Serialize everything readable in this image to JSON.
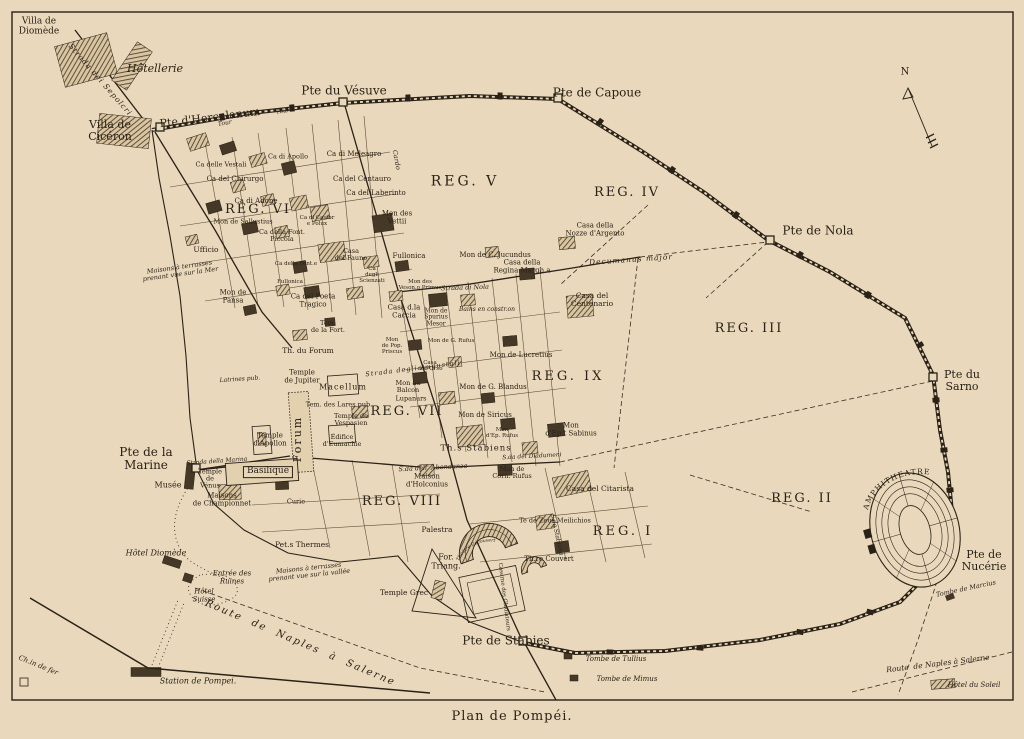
{
  "page": {
    "title": "Plan de Pompéi."
  },
  "colors": {
    "paper": "#e9d8bb",
    "ink": "#2a2217",
    "hatch": "#4a3c28"
  },
  "map": {
    "curved": {
      "amphitheatre": "AMPHITHEATRE",
      "grand_theatre": "Théâtre Découvert"
    },
    "labels": [
      {
        "n": "villa-de-diomede",
        "t": "Villa de\nDiomède",
        "x": 39,
        "y": 27,
        "s": 9
      },
      {
        "n": "hotellerie",
        "t": "Hôtellerie",
        "x": 155,
        "y": 69,
        "s": 11,
        "i": 1
      },
      {
        "n": "villa-de-ciceron",
        "t": "Villa de\nCicéron",
        "x": 110,
        "y": 131,
        "s": 11
      },
      {
        "n": "pte-herculanum",
        "t": "Pte d'Herculanum",
        "x": 210,
        "y": 118,
        "s": 11,
        "r": -7
      },
      {
        "n": "strada-dei-sepolcri",
        "t": "Strada dei Sepolcri",
        "x": 100,
        "y": 80,
        "s": 7.5,
        "i": 1,
        "r": 49,
        "l": 1
      },
      {
        "n": "tour-1",
        "t": "Tour",
        "x": 225,
        "y": 124,
        "s": 6,
        "i": 1,
        "r": -10
      },
      {
        "n": "tour-2",
        "t": "Tour",
        "x": 283,
        "y": 112,
        "s": 6,
        "i": 1,
        "r": -8
      },
      {
        "n": "pte-vesuve",
        "t": "Pte du Vésuve",
        "x": 344,
        "y": 91,
        "s": 12
      },
      {
        "n": "pte-capoue",
        "t": "Pte de Capoue",
        "x": 597,
        "y": 93,
        "s": 12
      },
      {
        "n": "pte-nola",
        "t": "Pte de Nola",
        "x": 818,
        "y": 231,
        "s": 12
      },
      {
        "n": "pte-sarno",
        "t": "Pte du\nSarno",
        "x": 962,
        "y": 381,
        "s": 11
      },
      {
        "n": "pte-nucerie",
        "t": "Pte de\nNucérie",
        "x": 984,
        "y": 561,
        "s": 11
      },
      {
        "n": "pte-stabies",
        "t": "Pte de Stabies",
        "x": 506,
        "y": 641,
        "s": 12
      },
      {
        "n": "pte-marine",
        "t": "Pte de la\nMarine",
        "x": 146,
        "y": 459,
        "s": 12
      },
      {
        "n": "compass-n",
        "t": "N",
        "x": 905,
        "y": 73,
        "s": 10
      },
      {
        "n": "reg-v",
        "t": "REG. V",
        "x": 465,
        "y": 182,
        "s": 14,
        "l": 3
      },
      {
        "n": "reg-iv",
        "t": "REG. IV",
        "x": 627,
        "y": 193,
        "s": 13,
        "l": 2
      },
      {
        "n": "reg-iii",
        "t": "REG. III",
        "x": 749,
        "y": 329,
        "s": 13,
        "l": 2
      },
      {
        "n": "reg-vi",
        "t": "REG. VI",
        "x": 258,
        "y": 210,
        "s": 13,
        "l": 2
      },
      {
        "n": "reg-ix",
        "t": "REG. IX",
        "x": 568,
        "y": 377,
        "s": 13,
        "l": 3
      },
      {
        "n": "reg-vii",
        "t": "REG. VII",
        "x": 407,
        "y": 412,
        "s": 13,
        "l": 2
      },
      {
        "n": "reg-viii",
        "t": "REG. VIII",
        "x": 402,
        "y": 502,
        "s": 13,
        "l": 2
      },
      {
        "n": "reg-ii",
        "t": "REG. II",
        "x": 802,
        "y": 499,
        "s": 13,
        "l": 2
      },
      {
        "n": "reg-i",
        "t": "REG. I",
        "x": 623,
        "y": 532,
        "s": 13,
        "l": 3
      },
      {
        "n": "ca-delle-vestali",
        "t": "Ca delle Vestali",
        "x": 221,
        "y": 165,
        "s": 6.5
      },
      {
        "n": "ca-del-chirurgo",
        "t": "Ca del Chirurgo",
        "x": 235,
        "y": 180,
        "s": 7
      },
      {
        "n": "ca-di-adone",
        "t": "Ca di Adone",
        "x": 256,
        "y": 202,
        "s": 7
      },
      {
        "n": "mon-de-sallustius",
        "t": "Mon de Sallustius",
        "x": 243,
        "y": 222,
        "s": 6.5
      },
      {
        "n": "ufficio",
        "t": "Ufficio",
        "x": 206,
        "y": 250,
        "s": 7.5
      },
      {
        "n": "ca-della-font-piccola",
        "t": "Ca della Font.\nPiccola",
        "x": 282,
        "y": 236,
        "s": 6.5
      },
      {
        "n": "ca-di-apollo",
        "t": "Ca di Apollo",
        "x": 288,
        "y": 157,
        "s": 6.5
      },
      {
        "n": "ca-di-meleagro",
        "t": "Ca di Meleagro",
        "x": 354,
        "y": 155,
        "s": 7
      },
      {
        "n": "ca-del-centauro",
        "t": "Ca del Centauro",
        "x": 362,
        "y": 180,
        "s": 7
      },
      {
        "n": "ca-del-laberinto",
        "t": "Ca del Laberinto",
        "x": 376,
        "y": 194,
        "s": 7
      },
      {
        "n": "mon-des-vettii",
        "t": "Mon des\nVettii",
        "x": 397,
        "y": 218,
        "s": 7
      },
      {
        "n": "ca-di-castor",
        "t": "Ca di Castor\ne Polux",
        "x": 317,
        "y": 222,
        "s": 5.5
      },
      {
        "n": "casa-del-fauno",
        "t": "Casa\ndel Fauno",
        "x": 351,
        "y": 255,
        "s": 6.5
      },
      {
        "n": "fullonica-1",
        "t": "Fullonica",
        "x": 409,
        "y": 257,
        "s": 7
      },
      {
        "n": "ca-degli-scienzati",
        "t": "Ca\ndegli\nScienzati",
        "x": 372,
        "y": 276,
        "s": 5.5
      },
      {
        "n": "mon-veson-primus",
        "t": "Mon des\nVeson.o Primus",
        "x": 420,
        "y": 286,
        "s": 5.5
      },
      {
        "n": "ca-del-poeta-tragico",
        "t": "Ca del Poeta\nTragico",
        "x": 313,
        "y": 301,
        "s": 7
      },
      {
        "n": "mon-de-pansa",
        "t": "Mon de\nPansa",
        "x": 233,
        "y": 297,
        "s": 7
      },
      {
        "n": "maisons-terrasses-mer",
        "t": "Maisons à terrasses\nprenant vue sur la Mer",
        "x": 180,
        "y": 271,
        "s": 6.5,
        "i": 1,
        "r": -8
      },
      {
        "n": "ca-della-fontana",
        "t": "Ca della Font.e",
        "x": 296,
        "y": 265,
        "s": 5.5
      },
      {
        "n": "fullonica-2",
        "t": "Fullonica",
        "x": 290,
        "y": 283,
        "s": 5.5
      },
      {
        "n": "tem-de-la-fortune",
        "t": "Tem.\nde la Fort.",
        "x": 328,
        "y": 327,
        "s": 6.5
      },
      {
        "n": "th-du-forum",
        "t": "Th. du Forum",
        "x": 308,
        "y": 351,
        "s": 7.5
      },
      {
        "n": "temple-de-jupiter",
        "t": "Temple\nde Jupiter",
        "x": 302,
        "y": 377,
        "s": 7
      },
      {
        "n": "macellum",
        "t": "Macellum",
        "x": 343,
        "y": 388,
        "s": 8,
        "l": 1
      },
      {
        "n": "tem-des-lares",
        "t": "Tem. des Lares pub.",
        "x": 339,
        "y": 405,
        "s": 6.5
      },
      {
        "n": "temple-vespasien",
        "t": "Temple de\nVespasien",
        "x": 351,
        "y": 420,
        "s": 6.5
      },
      {
        "n": "edifice-eumachie",
        "t": "Édifice\nd'Eumachie",
        "x": 342,
        "y": 441,
        "s": 6.5
      },
      {
        "n": "mon-au-balcon",
        "t": "Mon au\nBalcon",
        "x": 408,
        "y": 387,
        "s": 6.5
      },
      {
        "n": "lupanars",
        "t": "Lupanars",
        "x": 411,
        "y": 399,
        "s": 6.5
      },
      {
        "n": "temple-apollon",
        "t": "Temple\nd'Apollon",
        "x": 270,
        "y": 440,
        "s": 7
      },
      {
        "n": "forum",
        "t": "Forum",
        "x": 298,
        "y": 439,
        "s": 11,
        "r": -90,
        "l": 2
      },
      {
        "n": "basilique",
        "t": "Basilique",
        "x": 268,
        "y": 472,
        "s": 9,
        "b": 1
      },
      {
        "n": "latrines",
        "t": "Latrines pub.",
        "x": 240,
        "y": 380,
        "s": 6,
        "i": 1,
        "r": -4
      },
      {
        "n": "temple-de-venus",
        "t": "Temple\nde\nVénus",
        "x": 210,
        "y": 479,
        "s": 6.5
      },
      {
        "n": "musee",
        "t": "Musée",
        "x": 168,
        "y": 486,
        "s": 8
      },
      {
        "n": "maisons-championnet",
        "t": "Maisons\nde Championnet",
        "x": 222,
        "y": 500,
        "s": 7
      },
      {
        "n": "curie",
        "t": "Curie",
        "x": 296,
        "y": 502,
        "s": 6.5
      },
      {
        "n": "petits-thermes",
        "t": "Pet.s Thermes",
        "x": 302,
        "y": 545,
        "s": 7.5
      },
      {
        "n": "maison-holconius",
        "t": "Maison\nd'Holconius",
        "x": 427,
        "y": 481,
        "s": 7
      },
      {
        "n": "maisons-terrasses-vallee",
        "t": "Maisons à terrasses\nprenant vue sur la vallée",
        "x": 309,
        "y": 572,
        "s": 6.5,
        "i": 1,
        "r": -6
      },
      {
        "n": "hotel-diomede",
        "t": "Hôtel Diomède",
        "x": 156,
        "y": 554,
        "s": 8,
        "i": 1
      },
      {
        "n": "entree-des-ruines",
        "t": "Entrée des\nRuines",
        "x": 232,
        "y": 578,
        "s": 7,
        "i": 1
      },
      {
        "n": "hotel-suisse",
        "t": "Hôtel\nSuisse",
        "x": 204,
        "y": 596,
        "s": 7,
        "i": 1
      },
      {
        "n": "route-naples-salerne-1",
        "t": "Route  de  Naples  à  Salerne",
        "x": 300,
        "y": 644,
        "s": 10,
        "i": 1,
        "r": 23,
        "l": 2
      },
      {
        "n": "chemin-de-fer",
        "t": "Ch.in de fer",
        "x": 38,
        "y": 666,
        "s": 7,
        "i": 1,
        "r": 22
      },
      {
        "n": "station-de-pompei",
        "t": "Station de Pompei.",
        "x": 198,
        "y": 682,
        "s": 8,
        "i": 1
      },
      {
        "n": "tombe-de-tullius",
        "t": "Tombe de Tullius",
        "x": 616,
        "y": 660,
        "s": 7,
        "i": 1
      },
      {
        "n": "tombe-de-mimus",
        "t": "Tombe de Mimus",
        "x": 627,
        "y": 680,
        "s": 7,
        "i": 1
      },
      {
        "n": "hotel-du-soleil",
        "t": "Hôtel du Soleil",
        "x": 974,
        "y": 686,
        "s": 7,
        "i": 1
      },
      {
        "n": "route-naples-salerne-2",
        "t": "Route  de Naples à Salerne",
        "x": 938,
        "y": 664,
        "s": 7.5,
        "i": 1,
        "r": -7
      },
      {
        "n": "tombe-de-marcius",
        "t": "Tombe de Marcius",
        "x": 966,
        "y": 589,
        "s": 6.5,
        "i": 1,
        "r": -12
      },
      {
        "n": "casa-del-citarista",
        "t": "Casa del Citarista",
        "x": 600,
        "y": 489,
        "s": 7.5
      },
      {
        "n": "te-zeus-meilichios",
        "t": "Te de Zeus Meilichios",
        "x": 555,
        "y": 521,
        "s": 6.5
      },
      {
        "n": "theatre-couvert",
        "t": "Th.re Couvert",
        "x": 549,
        "y": 560,
        "s": 7
      },
      {
        "n": "palestra",
        "t": "Palestra",
        "x": 437,
        "y": 530,
        "s": 7.5
      },
      {
        "n": "forum-triangulaire",
        "t": "For.\nTriang.",
        "x": 446,
        "y": 562,
        "s": 8
      },
      {
        "n": "temple-grec",
        "t": "Temple Grec",
        "x": 404,
        "y": 593,
        "s": 7.5
      },
      {
        "n": "caserne-gladiateurs",
        "t": "Caserne des Gladiateurs",
        "x": 503,
        "y": 597,
        "s": 5.5,
        "r": 83
      },
      {
        "n": "mon-de-siricus",
        "t": "Mon de Siricus",
        "x": 485,
        "y": 416,
        "s": 7
      },
      {
        "n": "mon-ep-rufus",
        "t": "Mon\nd'Ep. Rufus",
        "x": 502,
        "y": 434,
        "s": 5.5
      },
      {
        "n": "thermes-stabiens",
        "t": "Th.s Stabiens",
        "x": 476,
        "y": 449,
        "s": 8.5,
        "l": 1
      },
      {
        "n": "mon-ept-sabinus",
        "t": "Mon\nd'Ep.t Sabinus",
        "x": 571,
        "y": 430,
        "s": 7
      },
      {
        "n": "mon-corn-rufus",
        "t": "Mon de\nCorn. Rufus",
        "x": 512,
        "y": 473,
        "s": 6.5
      },
      {
        "n": "mon-g-blandus",
        "t": "Mon de G. Blandus",
        "x": 493,
        "y": 388,
        "s": 7
      },
      {
        "n": "mon-de-lucretius",
        "t": "Mon de Lucretius",
        "x": 521,
        "y": 356,
        "s": 7
      },
      {
        "n": "bains-en-construction",
        "t": "Bains en constr.on",
        "x": 487,
        "y": 310,
        "s": 6,
        "i": 1
      },
      {
        "n": "casa-del-centenario",
        "t": "Casa del\nCentenario",
        "x": 592,
        "y": 300,
        "s": 7.5
      },
      {
        "n": "casa-regina-margherita",
        "t": "Casa della\nRegina Margh.a",
        "x": 522,
        "y": 267,
        "s": 7
      },
      {
        "n": "mon-c-jucundus",
        "t": "Mon de C. Jucundus",
        "x": 495,
        "y": 256,
        "s": 7
      },
      {
        "n": "casa-nozze-argento",
        "t": "Casa della\nNozze d'Argento",
        "x": 595,
        "y": 230,
        "s": 7
      },
      {
        "n": "decumanus-major",
        "t": "Decumanus major",
        "x": 631,
        "y": 260,
        "s": 7.5,
        "i": 1,
        "r": -4,
        "l": 1
      },
      {
        "n": "casa-della-caccia",
        "t": "Casa d.la\nCaccia",
        "x": 404,
        "y": 312,
        "s": 7
      },
      {
        "n": "mon-spurius-mesor",
        "t": "Mon de\nSpurius\nMesor",
        "x": 436,
        "y": 318,
        "s": 6
      },
      {
        "n": "mon-pop-priscus",
        "t": "Mon\nde Pop.\nPriscus",
        "x": 392,
        "y": 347,
        "s": 5.5
      },
      {
        "n": "casa-dell-orso",
        "t": "Casa\ndell'Orso",
        "x": 430,
        "y": 367,
        "s": 5.5
      },
      {
        "n": "mon-g-rufus",
        "t": "Mon de G. Rufus",
        "x": 451,
        "y": 342,
        "s": 5.5
      },
      {
        "n": "strada-augustali",
        "t": "Strada degli Augustali",
        "x": 413,
        "y": 369,
        "s": 6.5,
        "i": 1,
        "r": -7,
        "l": 1
      },
      {
        "n": "strada-di-nola",
        "t": "Strada di Nola",
        "x": 465,
        "y": 288,
        "s": 6.5,
        "i": 1,
        "r": -2
      },
      {
        "n": "strada-abbondanza",
        "t": "S.da dell' Abondanza",
        "x": 433,
        "y": 468,
        "s": 6.5,
        "i": 1,
        "r": -3
      },
      {
        "n": "strada-diadumeni",
        "t": "S.da dei Diadumeni",
        "x": 532,
        "y": 457,
        "s": 6,
        "i": 1,
        "r": -3
      },
      {
        "n": "strada-della-marina",
        "t": "Strada della Marina",
        "x": 217,
        "y": 462,
        "s": 6,
        "i": 1,
        "r": -4
      },
      {
        "n": "cardo",
        "t": "Cardo",
        "x": 396,
        "y": 160,
        "s": 6.5,
        "i": 1,
        "r": 80
      },
      {
        "n": "strada-stabiana",
        "t": "S.da Stabiana",
        "x": 556,
        "y": 535,
        "s": 6,
        "i": 1,
        "r": 78
      }
    ]
  }
}
